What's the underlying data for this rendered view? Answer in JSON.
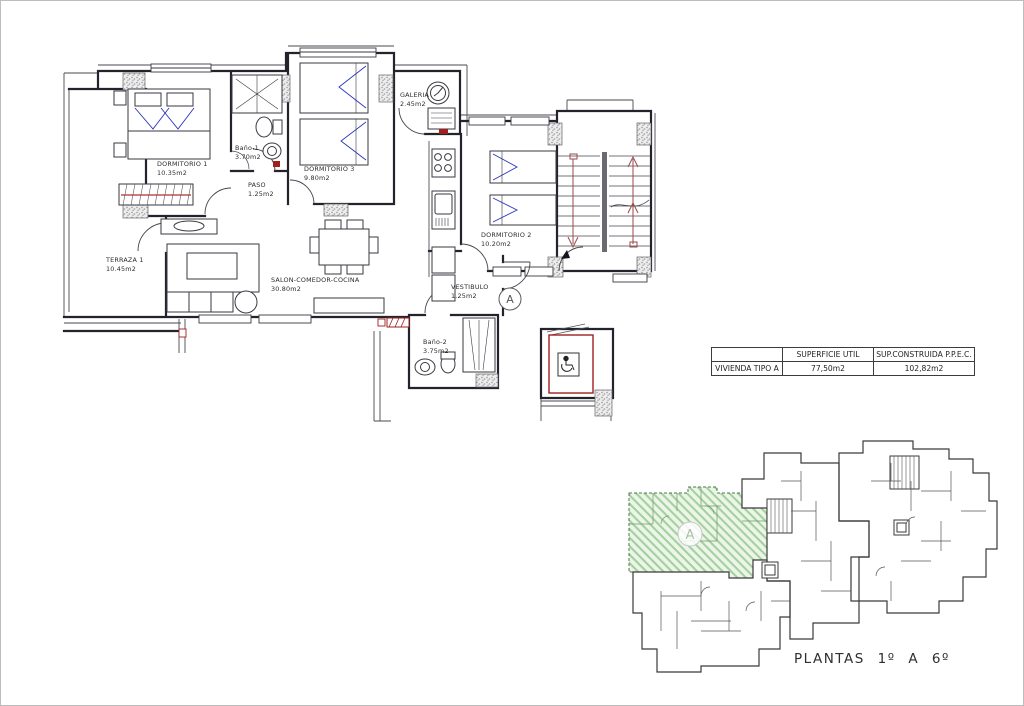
{
  "main_plan": {
    "rooms": [
      {
        "name": "TERRAZA 1",
        "area": "10.45m2"
      },
      {
        "name": "DORMITORIO 1",
        "area": "10.35m2"
      },
      {
        "name": "Baño-1",
        "area": "3.70m2"
      },
      {
        "name": "PASO",
        "area": "1.25m2"
      },
      {
        "name": "DORMITORIO 3",
        "area": "9.80m2"
      },
      {
        "name": "GALERIA",
        "area": "2.45m2"
      },
      {
        "name": "SALON-COMEDOR-COCINA",
        "area": "30.80m2"
      },
      {
        "name": "DORMITORIO 2",
        "area": "10.20m2"
      },
      {
        "name": "VESTIBULO",
        "area": "1.25m2"
      },
      {
        "name": "Baño-2",
        "area": "3.75m2"
      }
    ],
    "unit_marker": "A"
  },
  "summary_table": {
    "headers": [
      "",
      "SUPERFICIE UTIL",
      "SUP.CONSTRUIDA  P.P.E.C."
    ],
    "rows": [
      [
        "VIVIENDA TIPO  A",
        "77,50m2",
        "102,82m2"
      ]
    ]
  },
  "key_plan": {
    "unit_marker": "A",
    "caption": "PLANTAS  1º  A  6º",
    "highlight_color": "#a5cf9f",
    "accent_red": "#a02020",
    "accent_blue": "#2a35c0"
  }
}
